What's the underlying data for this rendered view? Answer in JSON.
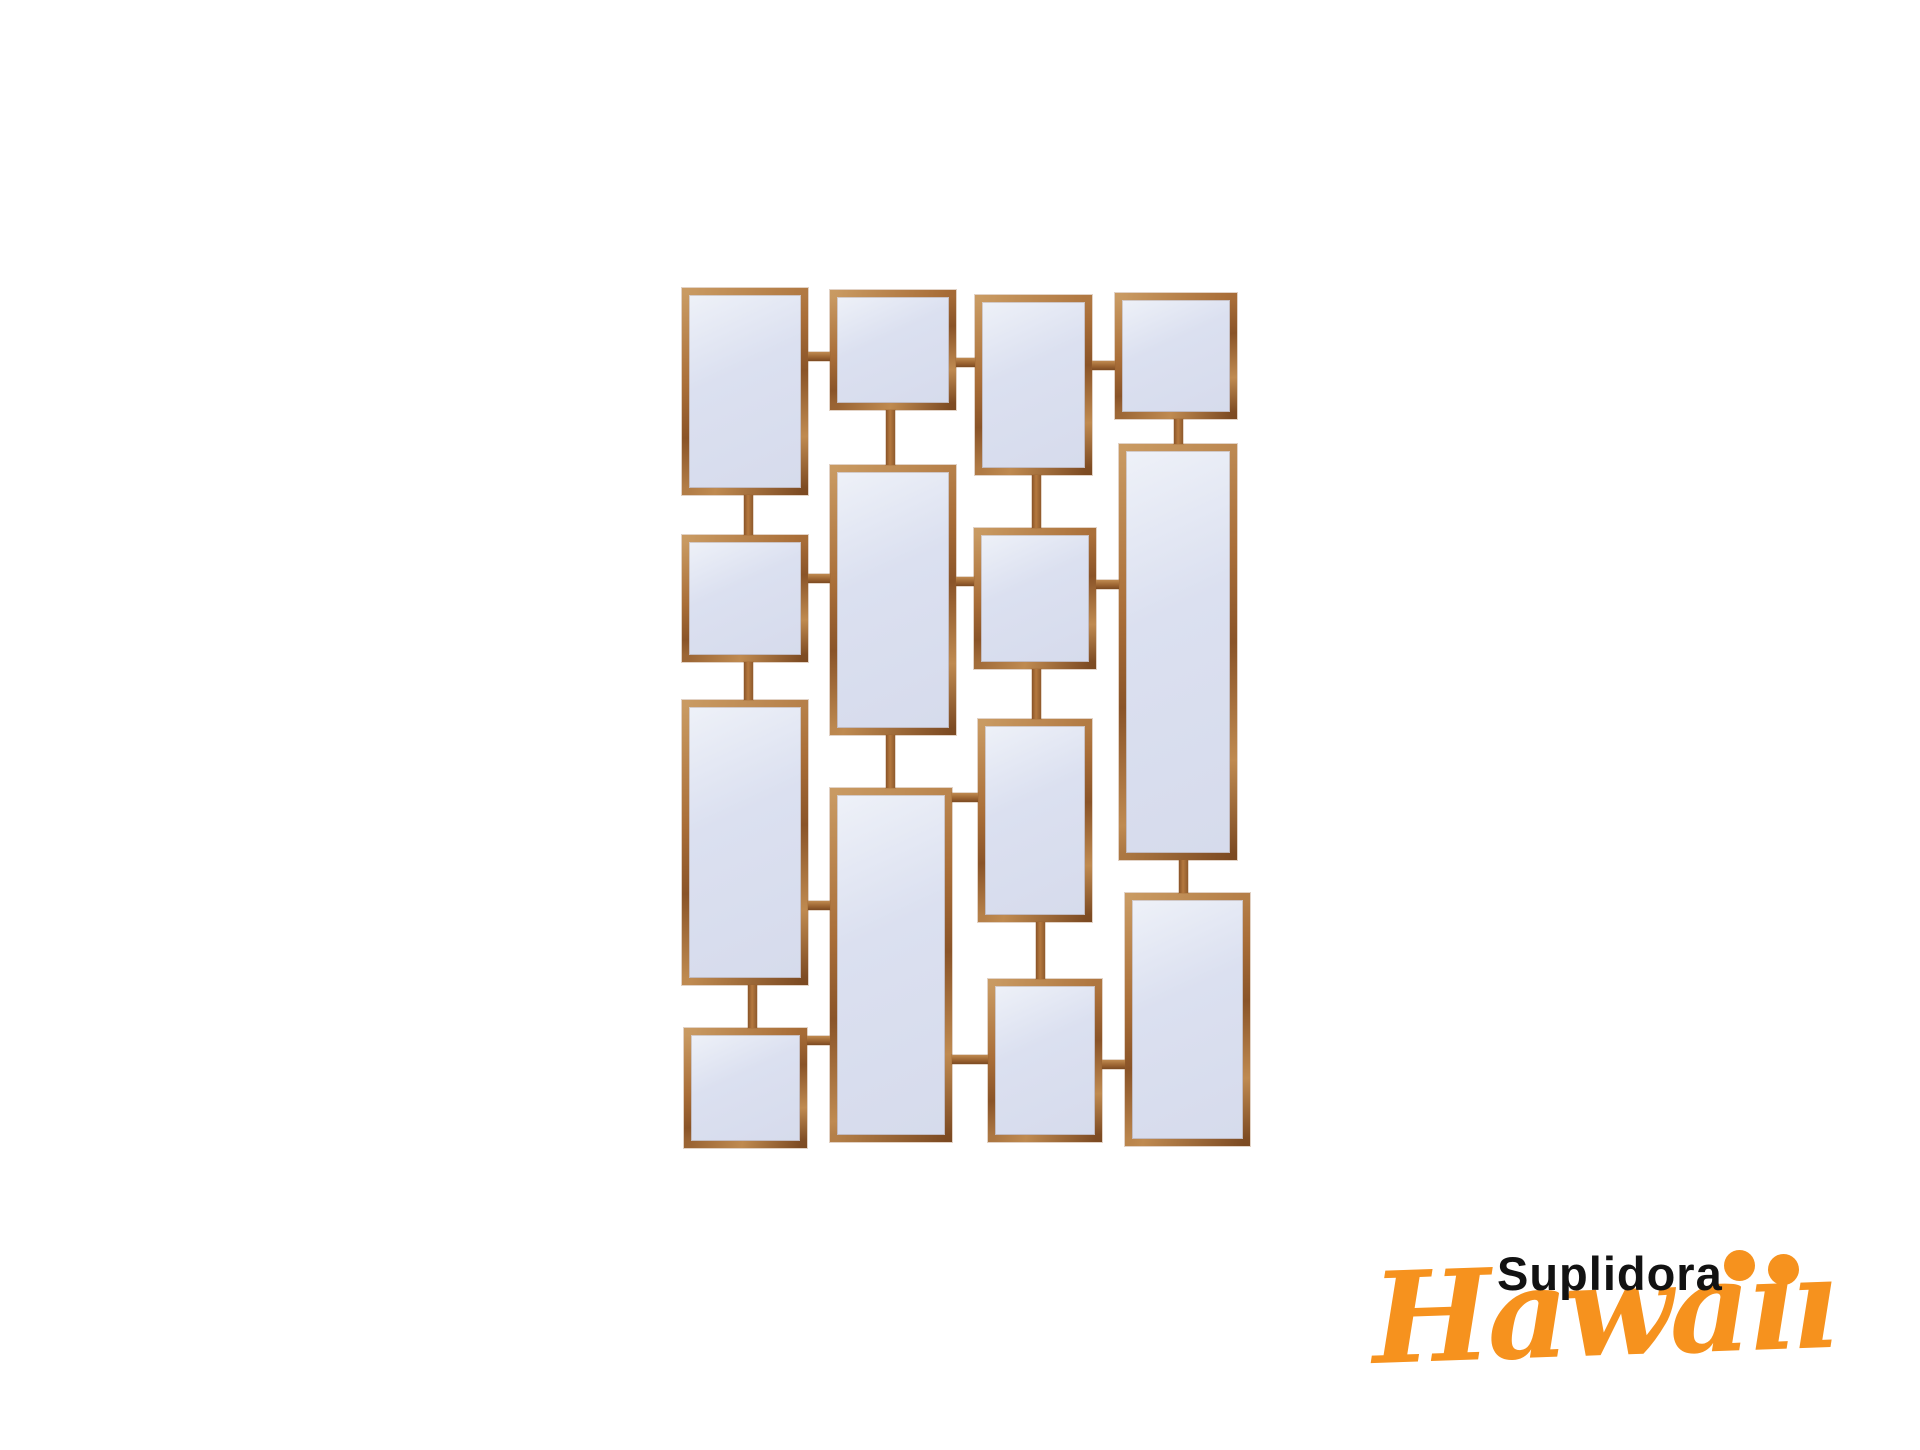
{
  "canvas": {
    "width": 1920,
    "height": 1450,
    "background": "#ffffff"
  },
  "product": {
    "name": "decorative-wall-mirror-collage",
    "description": "Rectangular gold-framed mirror panels joined by short metal links",
    "frame_color": "#a86b38",
    "glass_color": "#d7dcec",
    "panel_count": 14,
    "mirrors": [
      {
        "id": "col1-row1",
        "x": 682,
        "y": 288,
        "w": 126,
        "h": 207
      },
      {
        "id": "col1-row2",
        "x": 682,
        "y": 535,
        "w": 126,
        "h": 127
      },
      {
        "id": "col1-row3",
        "x": 682,
        "y": 700,
        "w": 126,
        "h": 285
      },
      {
        "id": "col1-row4",
        "x": 684,
        "y": 1028,
        "w": 123,
        "h": 120
      },
      {
        "id": "col2-row1",
        "x": 830,
        "y": 290,
        "w": 126,
        "h": 120
      },
      {
        "id": "col2-row2",
        "x": 830,
        "y": 465,
        "w": 126,
        "h": 270
      },
      {
        "id": "col2-row3",
        "x": 830,
        "y": 788,
        "w": 122,
        "h": 354
      },
      {
        "id": "col3-row1",
        "x": 975,
        "y": 295,
        "w": 117,
        "h": 180
      },
      {
        "id": "col3-row2",
        "x": 974,
        "y": 528,
        "w": 122,
        "h": 141
      },
      {
        "id": "col3-row3",
        "x": 978,
        "y": 719,
        "w": 114,
        "h": 203
      },
      {
        "id": "col3-row4",
        "x": 988,
        "y": 979,
        "w": 114,
        "h": 163
      },
      {
        "id": "col4-row1",
        "x": 1115,
        "y": 293,
        "w": 122,
        "h": 126
      },
      {
        "id": "col4-row2",
        "x": 1119,
        "y": 444,
        "w": 118,
        "h": 416
      },
      {
        "id": "col4-row3",
        "x": 1125,
        "y": 893,
        "w": 125,
        "h": 253
      }
    ],
    "connectors": [
      {
        "o": "v",
        "x": 744,
        "y": 495,
        "w": 9,
        "h": 40
      },
      {
        "o": "v",
        "x": 744,
        "y": 662,
        "w": 9,
        "h": 38
      },
      {
        "o": "v",
        "x": 748,
        "y": 985,
        "w": 9,
        "h": 43
      },
      {
        "o": "v",
        "x": 886,
        "y": 410,
        "w": 9,
        "h": 55
      },
      {
        "o": "v",
        "x": 886,
        "y": 735,
        "w": 9,
        "h": 53
      },
      {
        "o": "v",
        "x": 1032,
        "y": 475,
        "w": 9,
        "h": 53
      },
      {
        "o": "v",
        "x": 1032,
        "y": 669,
        "w": 9,
        "h": 50
      },
      {
        "o": "v",
        "x": 1036,
        "y": 922,
        "w": 9,
        "h": 57
      },
      {
        "o": "v",
        "x": 1174,
        "y": 419,
        "w": 9,
        "h": 25
      },
      {
        "o": "v",
        "x": 1179,
        "y": 860,
        "w": 9,
        "h": 33
      },
      {
        "o": "h",
        "x": 808,
        "y": 352,
        "w": 22,
        "h": 9
      },
      {
        "o": "h",
        "x": 956,
        "y": 358,
        "w": 19,
        "h": 9
      },
      {
        "o": "h",
        "x": 1092,
        "y": 361,
        "w": 23,
        "h": 9
      },
      {
        "o": "h",
        "x": 808,
        "y": 574,
        "w": 22,
        "h": 9
      },
      {
        "o": "h",
        "x": 956,
        "y": 577,
        "w": 18,
        "h": 9
      },
      {
        "o": "h",
        "x": 1096,
        "y": 580,
        "w": 23,
        "h": 9
      },
      {
        "o": "h",
        "x": 808,
        "y": 901,
        "w": 22,
        "h": 9
      },
      {
        "o": "h",
        "x": 952,
        "y": 793,
        "w": 26,
        "h": 9
      },
      {
        "o": "h",
        "x": 807,
        "y": 1036,
        "w": 23,
        "h": 9
      },
      {
        "o": "h",
        "x": 952,
        "y": 1055,
        "w": 36,
        "h": 9
      },
      {
        "o": "h",
        "x": 1102,
        "y": 1060,
        "w": 23,
        "h": 9
      }
    ]
  },
  "watermark": {
    "line1": "Suplidora",
    "line2": "Hawaii",
    "line1_color": "#121212",
    "line2_color": "#f6921e"
  }
}
